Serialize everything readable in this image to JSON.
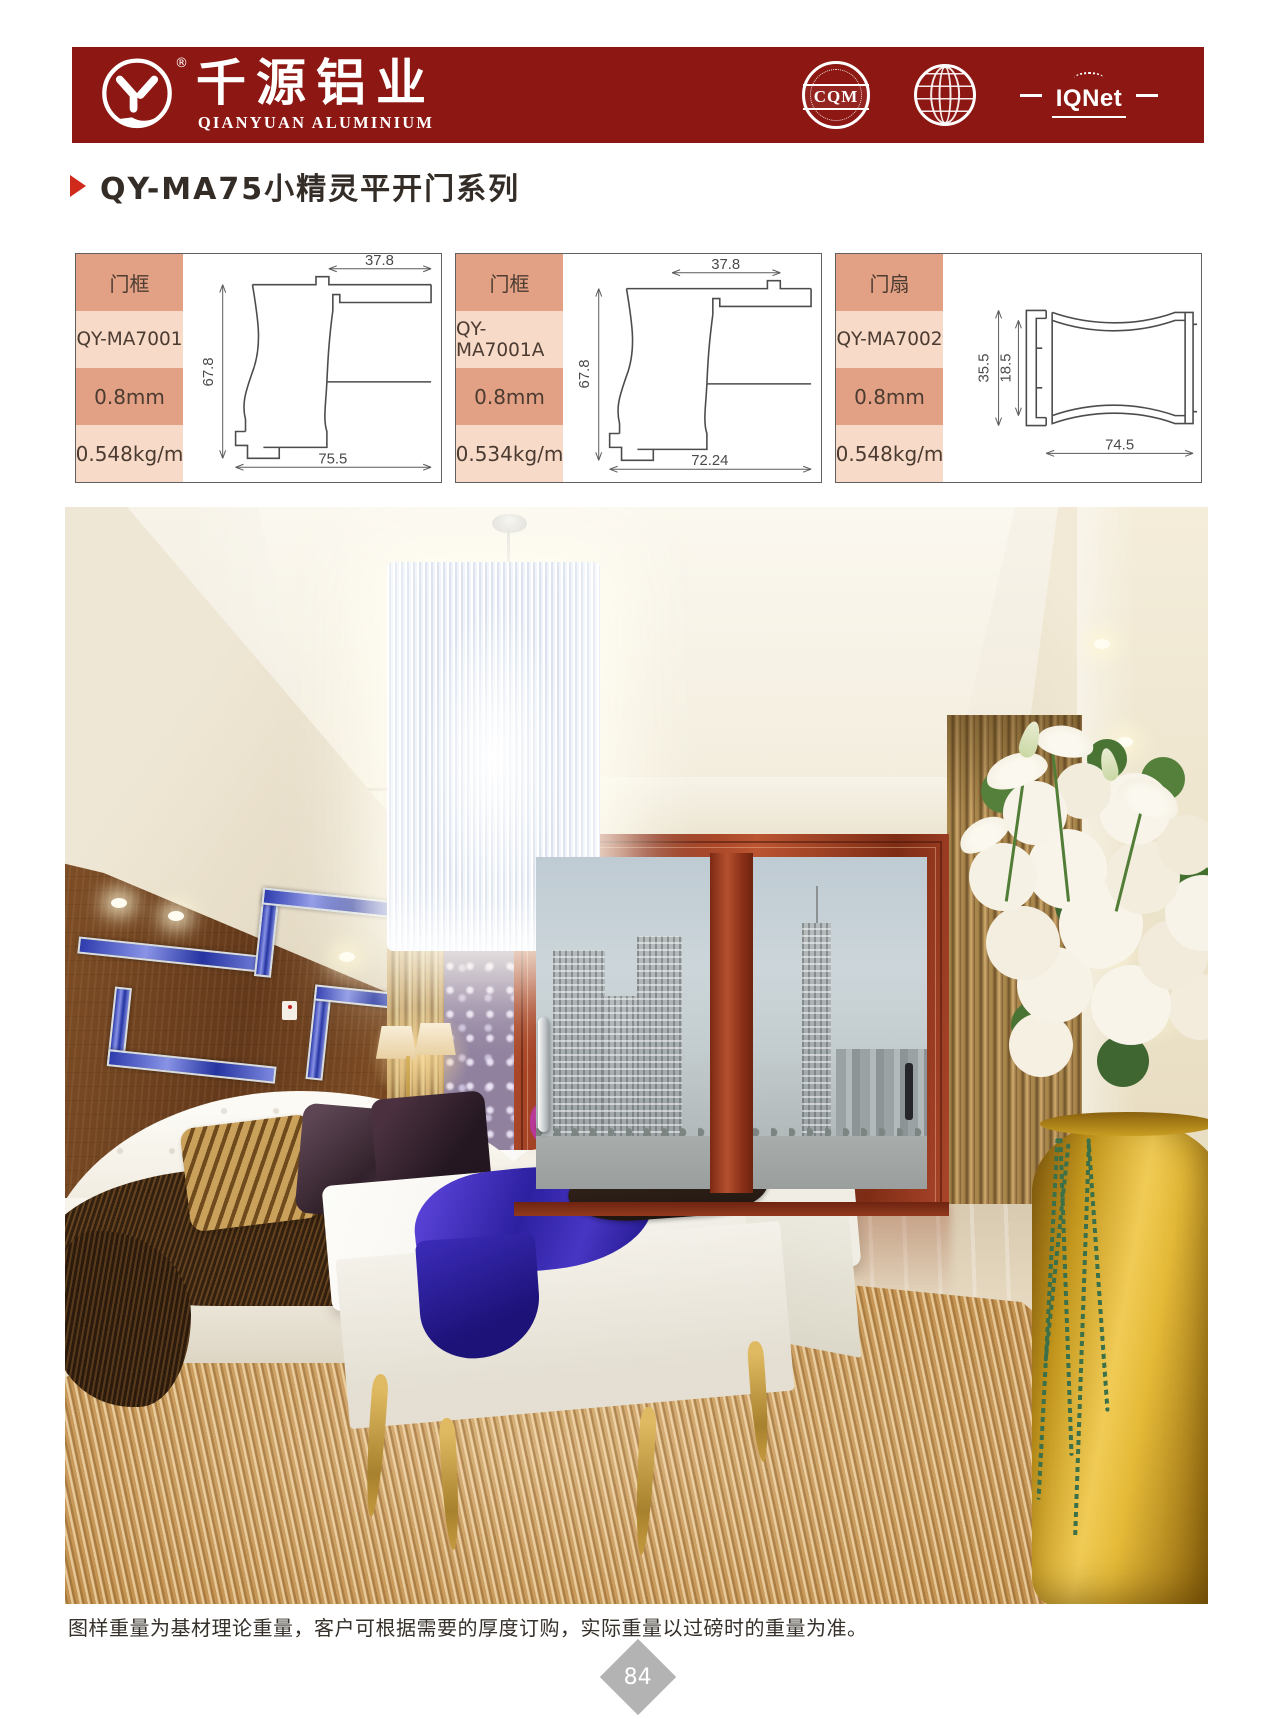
{
  "brand": {
    "name_cn": "千源铝业",
    "name_en": "QIANYUAN ALUMINIUM",
    "registered": "®"
  },
  "certs": {
    "cqm": "CQM",
    "iqnet": "IQNet"
  },
  "title": {
    "text": "QY-MA75小精灵平开门系列"
  },
  "cards": [
    {
      "type": "门框",
      "model": "QY-MA7001",
      "thickness": "0.8mm",
      "weight": "0.548kg/m",
      "dims": {
        "top": "37.8",
        "left": "67.8",
        "bottom": "75.5"
      }
    },
    {
      "type": "门框",
      "model": "QY-MA7001A",
      "thickness": "0.8mm",
      "weight": "0.534kg/m",
      "dims": {
        "top": "37.8",
        "left": "67.8",
        "bottom": "72.24"
      }
    },
    {
      "type": "门扇",
      "model": "QY-MA7002",
      "thickness": "0.8mm",
      "weight": "0.548kg/m",
      "dims": {
        "outer": "35.5",
        "inner": "18.5",
        "bottom": "74.5"
      }
    }
  ],
  "footer": {
    "note": "图样重量为基材理论重量，客户可根据需要的厚度订购，实际重量以过磅时的重量为准。",
    "page_number": "84"
  },
  "colors": {
    "header_red": "#8D1712",
    "accent_red": "#CF2A1B",
    "card_row_dark": "#E2A184",
    "card_row_light": "#F7DAC8"
  }
}
